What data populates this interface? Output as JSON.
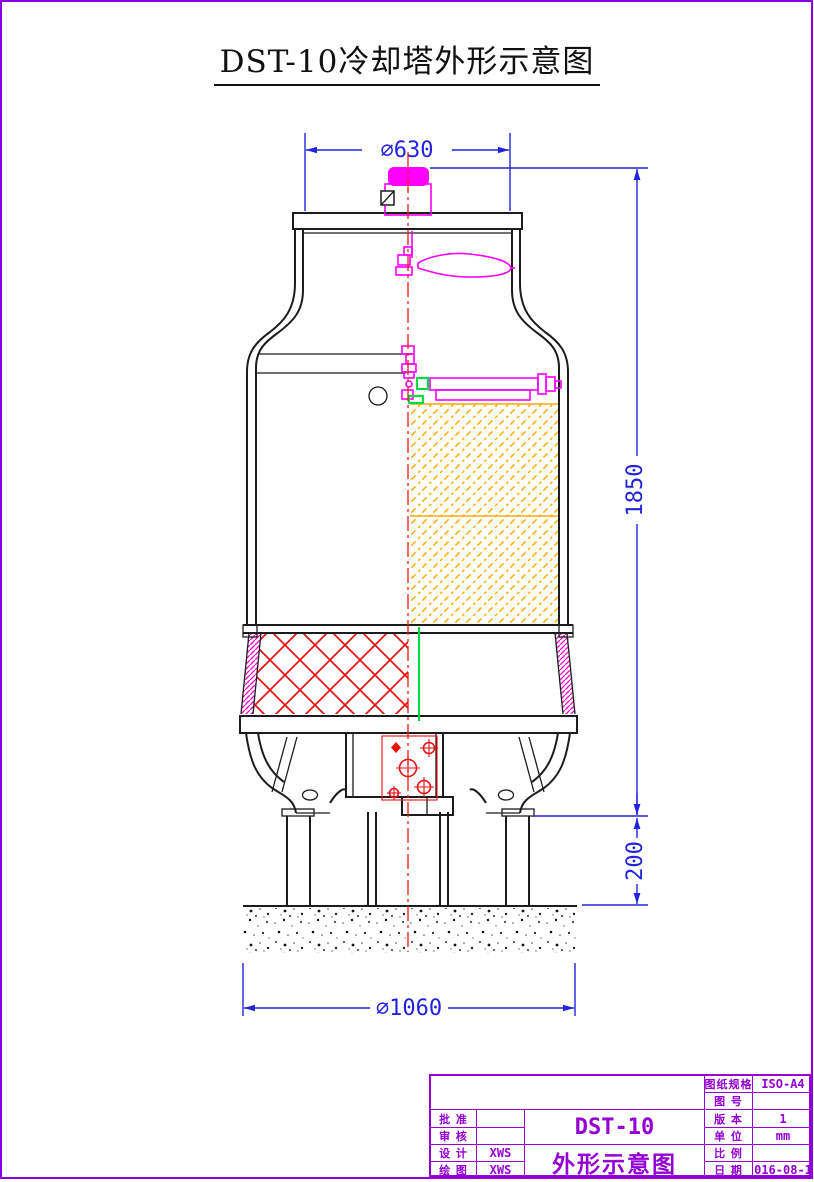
{
  "page": {
    "title": "DST-10冷却塔外形示意图"
  },
  "dimensions": {
    "top_diameter": "∅630",
    "overall_height": "1850",
    "base_height": "200",
    "base_diameter": "∅1060"
  },
  "title_block": {
    "doc_rows": [
      {
        "label": "图纸规格",
        "value": "ISO-A4"
      },
      {
        "label": "图 号",
        "value": ""
      },
      {
        "label": "版 本",
        "value": "1"
      },
      {
        "label": "单 位",
        "value": "mm"
      },
      {
        "label": "比 例",
        "value": ""
      },
      {
        "label": "日 期",
        "value": "2016-08-19"
      }
    ],
    "sign_rows": [
      {
        "label": "批 准",
        "value": ""
      },
      {
        "label": "审 核",
        "value": ""
      },
      {
        "label": "设 计",
        "value": "XWS"
      },
      {
        "label": "绘 图",
        "value": "XWS"
      }
    ],
    "model": "DST-10",
    "drawing_name": "外形示意图"
  },
  "colors": {
    "dimension_blue": "#2323de",
    "centerline_red": "#f01818",
    "component_magenta": "#ff00ff",
    "fill_hatch_orange": "#ffaa00",
    "riser_green": "#00d844",
    "frame_purple": "#8a00e0",
    "titleblock_purple": "#9400d3",
    "outline_black": "#1c1c1c"
  }
}
